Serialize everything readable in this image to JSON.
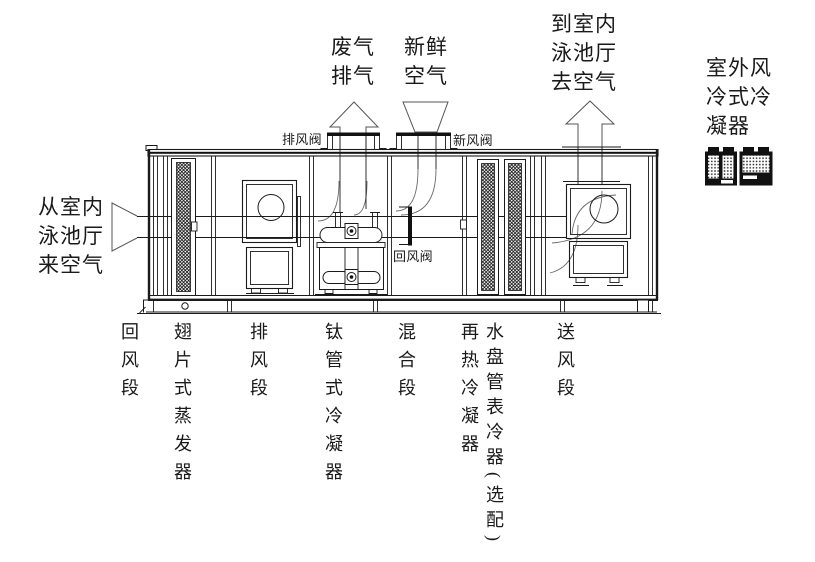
{
  "colors": {
    "line": "#1a1a1a",
    "flow_line": "#6a6a6a"
  },
  "labels": {
    "air_from_pool": [
      "从室内",
      "泳池厅",
      "来空气"
    ],
    "waste_exhaust_air": [
      "废气",
      "排气"
    ],
    "fresh_air": [
      "新鲜",
      "空气"
    ],
    "air_to_pool": [
      "到室内",
      "泳池厅",
      "去空气"
    ],
    "outdoor_condenser": [
      "室外风",
      "冷式冷",
      "凝器"
    ],
    "exhaust_damper": "排风阀",
    "fresh_air_damper": "新风阀",
    "return_air_damper": "回风阀"
  },
  "sections": [
    {
      "label": "回风段"
    },
    {
      "label": "翅片式蒸发器"
    },
    {
      "label": "排风段"
    },
    {
      "label": "钛管式冷凝器"
    },
    {
      "label": "混合段"
    },
    {
      "label": "再热冷凝器"
    },
    {
      "label": "水盘管表冷器(选配)"
    },
    {
      "label": "送风段"
    }
  ]
}
